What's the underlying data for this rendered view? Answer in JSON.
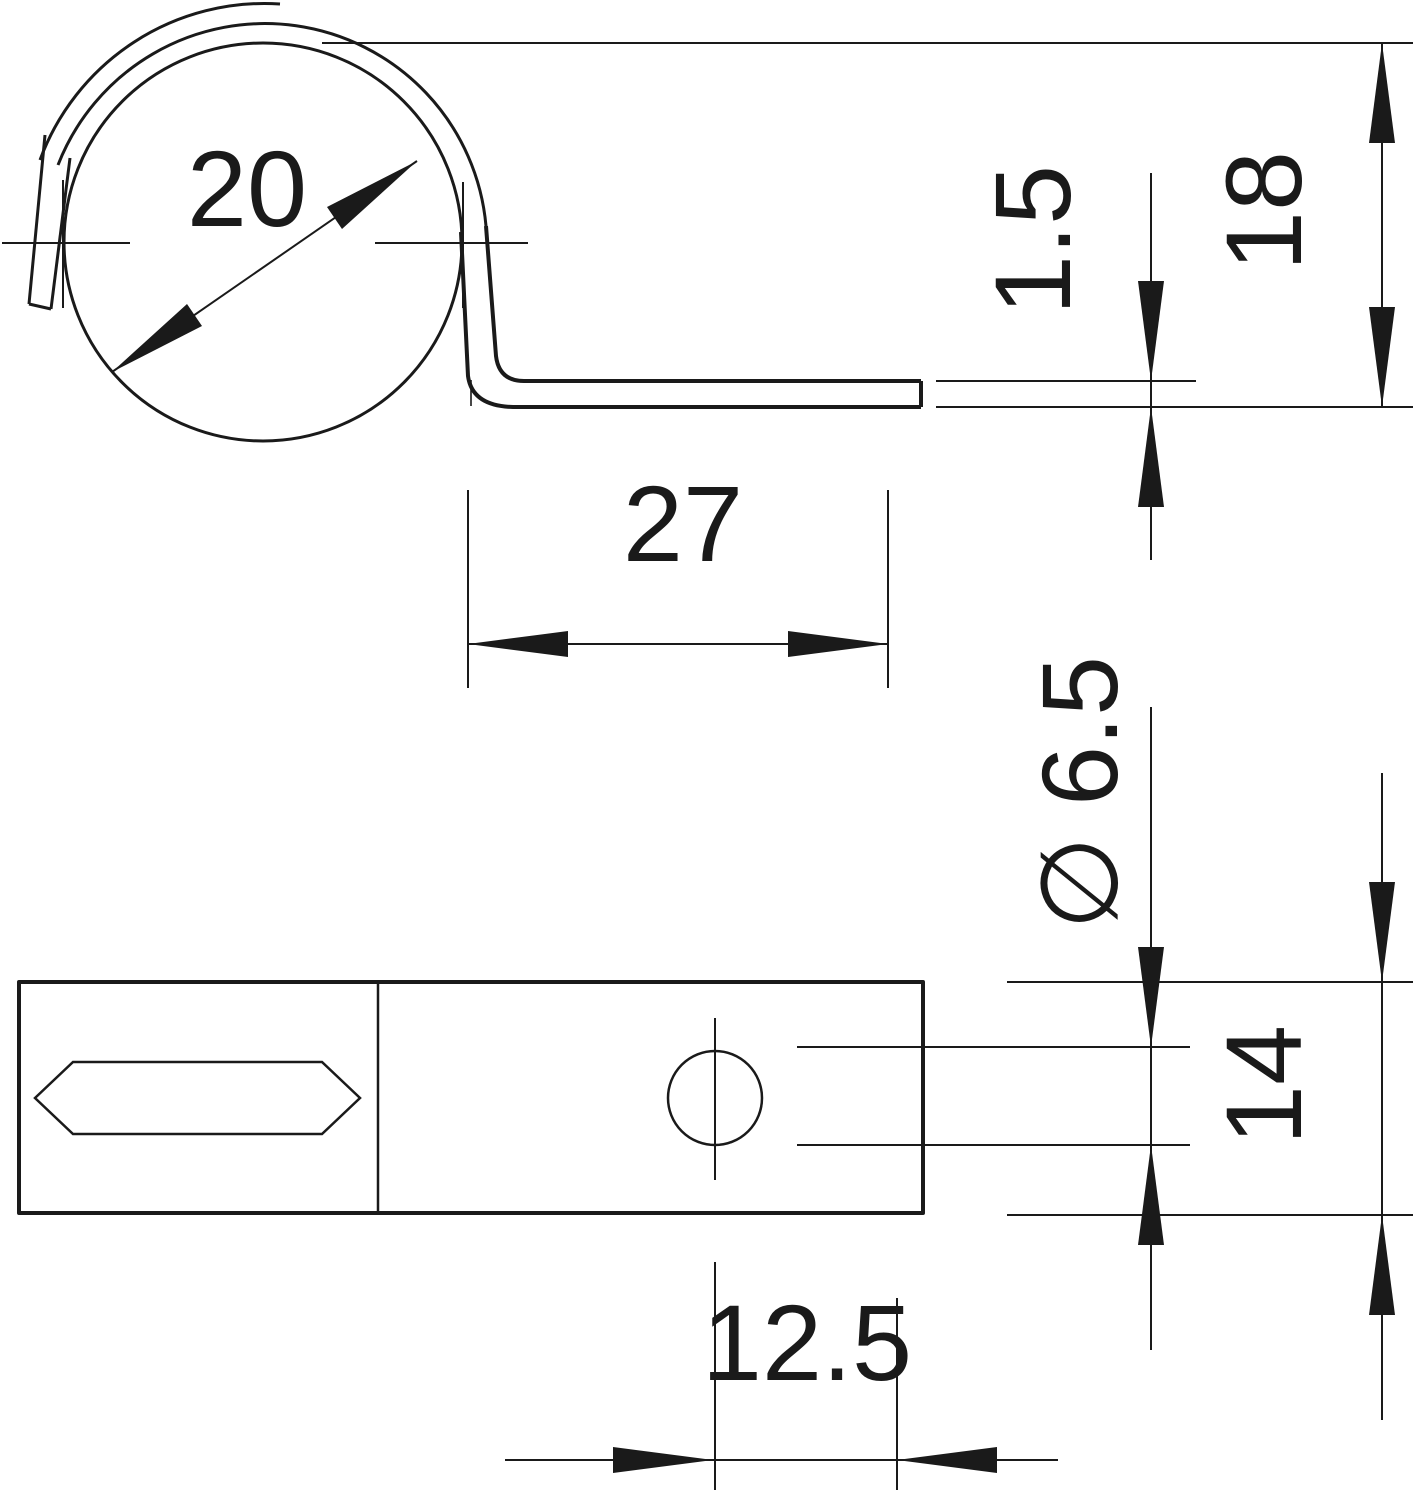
{
  "drawing": {
    "background_color": "#ffffff",
    "line_color": "#1a1a1a",
    "views": {
      "side_view": {
        "loop_diameter_label": "20",
        "foot_length_label": "27",
        "thickness_label": "1.5",
        "height_label": "18"
      },
      "bottom_view": {
        "hole_diameter_label": "∅ 6.5",
        "width_label": "14",
        "hole_offset_label": "12.5"
      }
    }
  }
}
